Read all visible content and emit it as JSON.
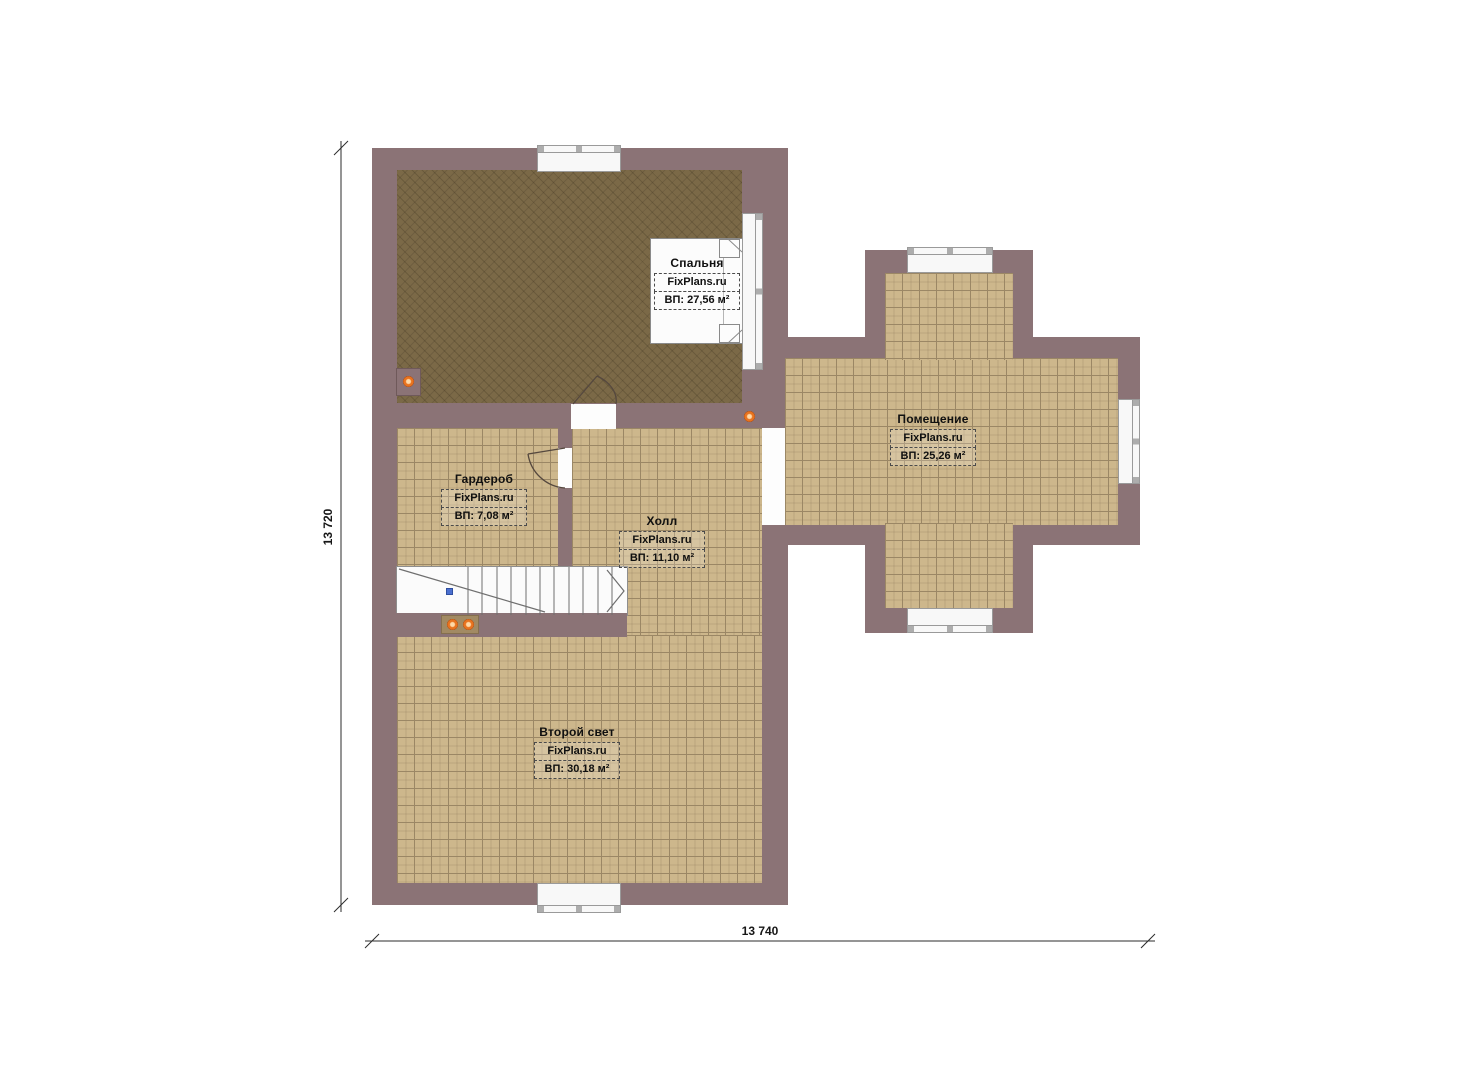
{
  "plan": {
    "rooms": [
      {
        "name": "Спальня",
        "brand": "FixPlans.ru",
        "area": "ВП: 27,56 м²"
      },
      {
        "name": "Гардероб",
        "brand": "FixPlans.ru",
        "area": "ВП: 7,08 м²"
      },
      {
        "name": "Холл",
        "brand": "FixPlans.ru",
        "area": "ВП: 11,10 м²"
      },
      {
        "name": "Помещение",
        "brand": "FixPlans.ru",
        "area": "ВП: 25,26 м²"
      },
      {
        "name": "Второй свет",
        "brand": "FixPlans.ru",
        "area": "ВП: 30,18 м²"
      }
    ],
    "dimensions": {
      "height_label": "13 720",
      "width_label": "13 740"
    },
    "colors": {
      "wall": "#8b7376",
      "bedroom_floor": "#7b6947",
      "tile_floor": "#cdb78c",
      "tile_grid": "#9b8765",
      "window": "#f8f8f8",
      "light_dot": "#e8731f",
      "stair_marker": "#4a6fd0"
    }
  }
}
